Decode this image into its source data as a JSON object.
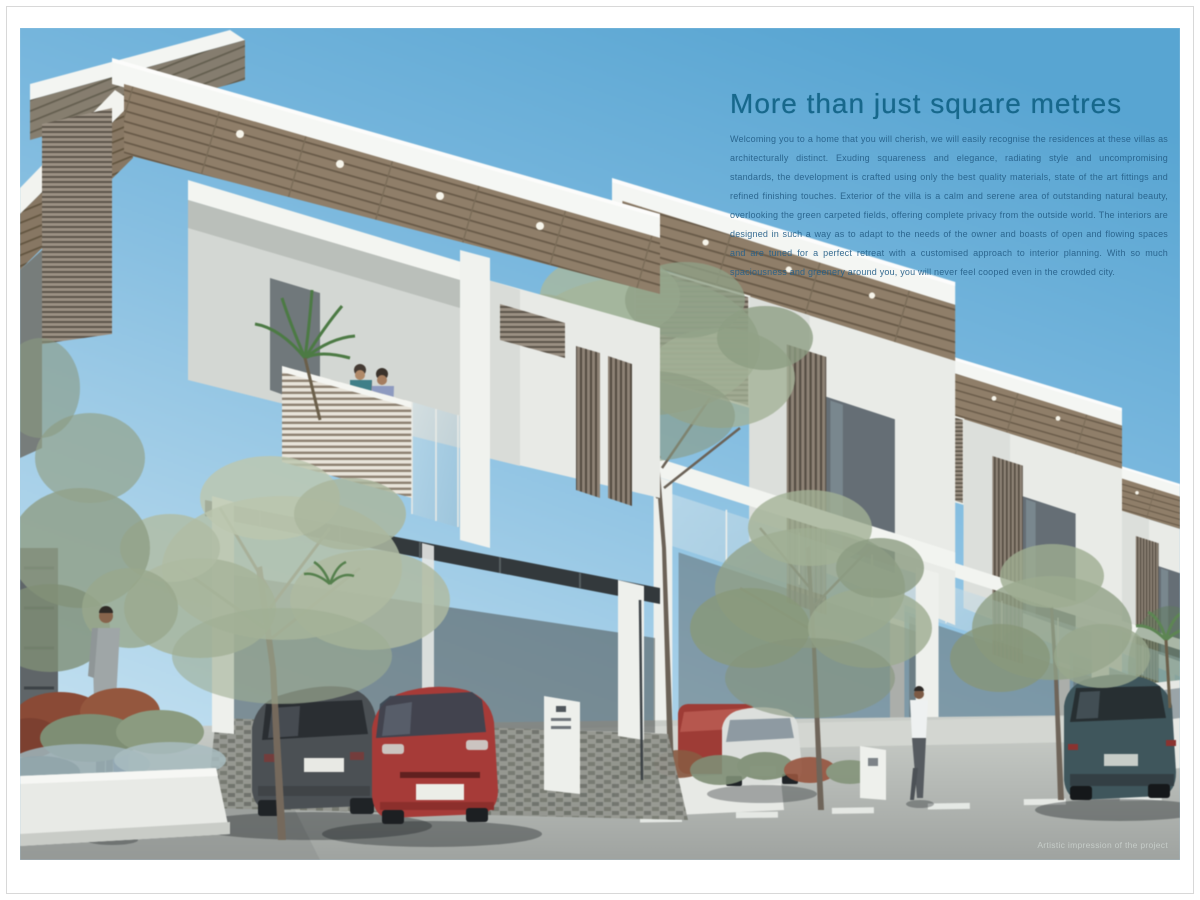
{
  "hero": {
    "headline": "More than just square metres",
    "body": "Welcoming you to a home that you will cherish, we will easily recognise the residences at these villas as architecturally distinct. Exuding squareness and elegance, radiating style and uncompromising standards, the development is crafted using only the best quality materials, state of the art fittings and refined finishing touches. Exterior of the villa is a calm and serene area of outstanding natural beauty, overlooking the green carpeted fields, offering complete privacy from the outside world. The interiors are designed in such a way as to adapt to the needs of the owner and boasts of open and flowing spaces and are tuned for a perfect retreat with a customised approach to interior planning. With so much spaciousness and greenery around you, you will never feel cooped even in the crowded city.",
    "caption": "Artistic impression of the project"
  },
  "colors": {
    "sky_top": "#58a5d2",
    "sky_bottom": "#c6e2f1",
    "headline": "#17688c",
    "body_text": "#266089",
    "caption": "#ccd3cf",
    "wood": "#8f7e69",
    "wall_white": "#e9ebe7",
    "road": "#b6bab6",
    "red_car": "#a63b38",
    "teal_car": "#3f565c"
  }
}
